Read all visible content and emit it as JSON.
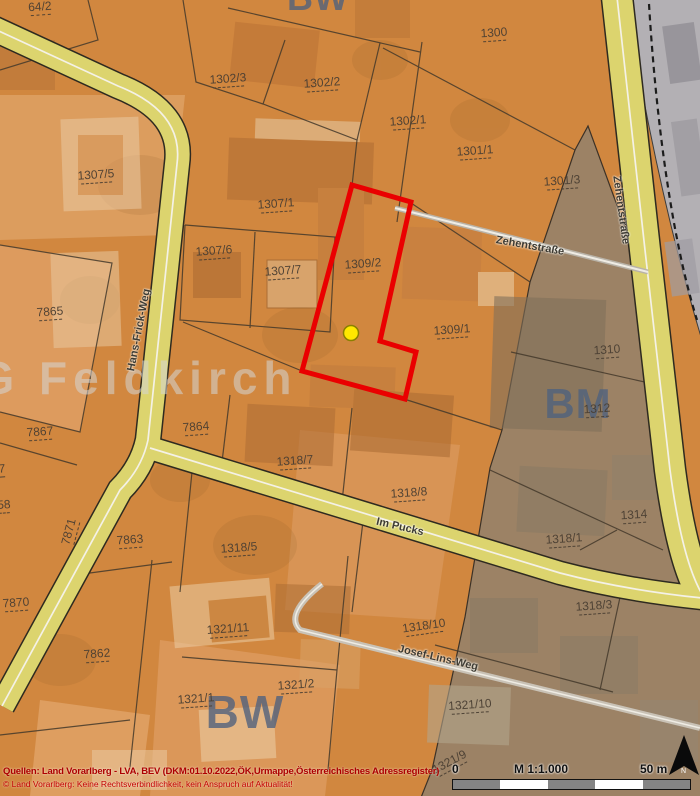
{
  "map": {
    "selected_parcel": "1309/2",
    "parcel_labels": [
      {
        "text": "64/2",
        "x": 40,
        "y": 8,
        "rot": -4
      },
      {
        "text": "1302/3",
        "x": 228,
        "y": 80,
        "rot": -4
      },
      {
        "text": "1302/2",
        "x": 322,
        "y": 84,
        "rot": -4
      },
      {
        "text": "1302/1",
        "x": 408,
        "y": 122,
        "rot": -4
      },
      {
        "text": "1300",
        "x": 494,
        "y": 34,
        "rot": -4
      },
      {
        "text": "1301/1",
        "x": 475,
        "y": 152,
        "rot": -4
      },
      {
        "text": "1301/3",
        "x": 562,
        "y": 182,
        "rot": -4
      },
      {
        "text": "1307/5",
        "x": 96,
        "y": 176,
        "rot": -4
      },
      {
        "text": "1307/1",
        "x": 276,
        "y": 205,
        "rot": -4
      },
      {
        "text": "1307/6",
        "x": 214,
        "y": 252,
        "rot": -4
      },
      {
        "text": "1307/7",
        "x": 283,
        "y": 272,
        "rot": -4
      },
      {
        "text": "1309/2",
        "x": 363,
        "y": 265,
        "rot": -4
      },
      {
        "text": "1309/1",
        "x": 452,
        "y": 331,
        "rot": -4
      },
      {
        "text": "1310",
        "x": 607,
        "y": 351,
        "rot": -4
      },
      {
        "text": "1312",
        "x": 597,
        "y": 410,
        "rot": -4
      },
      {
        "text": "7865",
        "x": 50,
        "y": 313,
        "rot": -4
      },
      {
        "text": "7867",
        "x": 40,
        "y": 433,
        "rot": -4
      },
      {
        "text": "7864",
        "x": 196,
        "y": 428,
        "rot": -4
      },
      {
        "text": "1318/7",
        "x": 295,
        "y": 462,
        "rot": -4
      },
      {
        "text": "1318/8",
        "x": 409,
        "y": 494,
        "rot": -4
      },
      {
        "text": "1314",
        "x": 634,
        "y": 516,
        "rot": -4
      },
      {
        "text": "1318/1",
        "x": 564,
        "y": 540,
        "rot": -4
      },
      {
        "text": "7863",
        "x": 130,
        "y": 541,
        "rot": -4
      },
      {
        "text": "1318/5",
        "x": 239,
        "y": 549,
        "rot": -4
      },
      {
        "text": "7871",
        "x": 70,
        "y": 532,
        "rot": -75
      },
      {
        "text": "7870",
        "x": 16,
        "y": 604,
        "rot": -4
      },
      {
        "text": "58",
        "x": 4,
        "y": 506,
        "rot": -4
      },
      {
        "text": "7",
        "x": 2,
        "y": 470,
        "rot": -4
      },
      {
        "text": "1321/11",
        "x": 228,
        "y": 630,
        "rot": -4
      },
      {
        "text": "1318/10",
        "x": 424,
        "y": 627,
        "rot": -8
      },
      {
        "text": "1318/3",
        "x": 594,
        "y": 607,
        "rot": -4
      },
      {
        "text": "7862",
        "x": 97,
        "y": 655,
        "rot": -4
      },
      {
        "text": "1321/2",
        "x": 296,
        "y": 686,
        "rot": -4
      },
      {
        "text": "1321/1",
        "x": 196,
        "y": 700,
        "rot": -4
      },
      {
        "text": "1321/10",
        "x": 470,
        "y": 706,
        "rot": -4
      },
      {
        "text": "1321/9",
        "x": 450,
        "y": 763,
        "rot": -28
      }
    ],
    "road_labels": [
      {
        "text": "Hans-Frick-Weg",
        "x": 139,
        "y": 330,
        "rot": -79
      },
      {
        "text": "Zehentstraße",
        "x": 530,
        "y": 246,
        "rot": 10
      },
      {
        "text": "Zehentstraße",
        "x": 621,
        "y": 210,
        "rot": 82
      },
      {
        "text": "Im Pucks",
        "x": 400,
        "y": 527,
        "rot": 13
      },
      {
        "text": "Josef-Lins-Weg",
        "x": 438,
        "y": 658,
        "rot": 13
      }
    ],
    "zone_watermarks": [
      {
        "text": "BW",
        "x": 318,
        "y": -2,
        "size": 36,
        "light": false
      },
      {
        "text": "BW",
        "x": 245,
        "y": 712,
        "size": 46,
        "light": false
      },
      {
        "text": "BM",
        "x": 578,
        "y": 404,
        "size": 42,
        "light": false
      },
      {
        "text": "G Feldkirch",
        "x": 138,
        "y": 378,
        "size": 46,
        "light": true
      }
    ],
    "marker": {
      "name": "selection-dot",
      "color": "#ffe800"
    },
    "colors": {
      "parcel_orange": "#d1873f",
      "zone_brown": "#9c8265",
      "zone_rail_gray": "#b3b0b4",
      "road_yellow": "#dcd46e",
      "selection_red": "#ea0000",
      "label_brown": "#4a3f33",
      "watermark_blue": "#50627e"
    }
  },
  "footer": {
    "source_line": "Quellen: Land Vorarlberg - LVA, BEV (DKM:01.10.2022,ÖK,Urmappe,Österreichisches Adressregister)",
    "disclaimer_line": "© Land Vorarlberg: Keine Rechtsverbindlichkeit, kein Anspruch auf Aktualität!",
    "scale_zero": "0",
    "scale_ratio": "M 1:1.000",
    "scale_distance": "50 m",
    "north_label": "N"
  }
}
